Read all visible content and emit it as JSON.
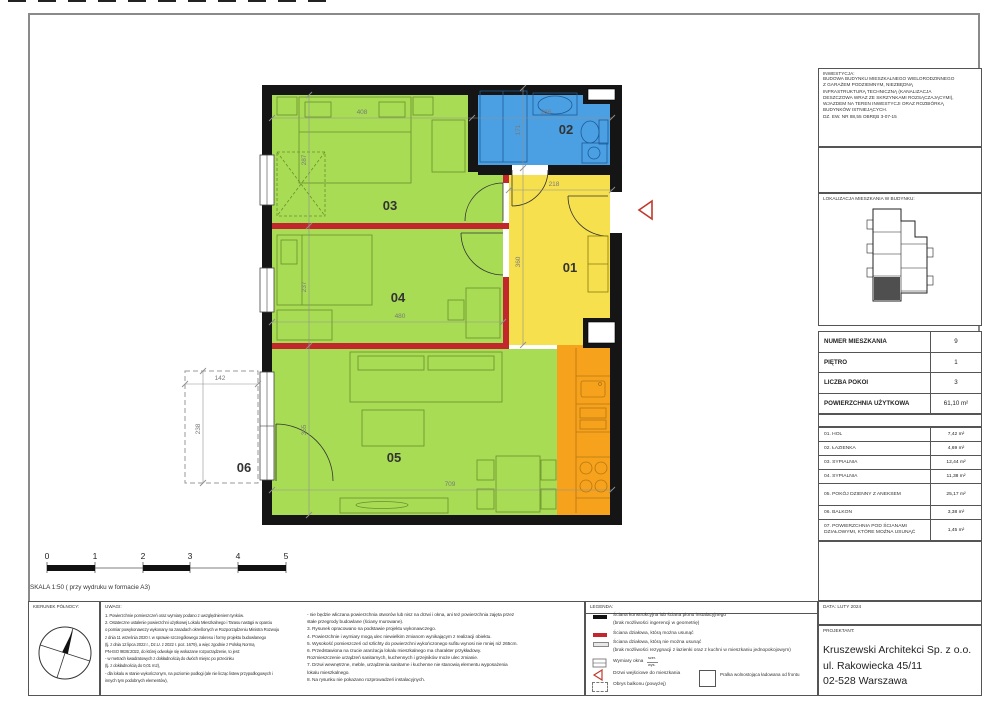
{
  "sheet": {
    "inwestycja": {
      "label": "INWESTYCJA:",
      "lines": [
        "BUDOWA BUDYNKU MIESZKALNEGO WIELORODZINNEGO",
        "Z GARAŻEM PODZIEMNYM, NIEZBĘDNĄ",
        "INFRASTRUKTURĄ TECHNICZNĄ (KANALIZACJA",
        "DESZCZOWA WRAZ ZE SKRZYNKAMI ROZSĄCZAJĄCYMI),",
        "WJAZDEM NA TEREN INWESTYCJI ORAZ ROZBIÓRKĄ",
        "BUDYNKÓW ISTNIEJĄCYCH.",
        "DZ. EW. NR 88,55 OBRĘB 3-07-15"
      ]
    },
    "lokalizacja_label": "LOKALIZACJA MIESZKANIA W BUDYNKU:",
    "apartment": {
      "rows": [
        {
          "label": "NUMER MIESZKANIA",
          "value": "9"
        },
        {
          "label": "PIĘTRO",
          "value": "1"
        },
        {
          "label": "LICZBA POKOI",
          "value": "3"
        },
        {
          "label": "POWIERZCHNIA UŻYTKOWA",
          "value": "61,10 m²"
        }
      ]
    },
    "areas": {
      "rows": [
        {
          "label": "01. HOL",
          "value": "7,42 m²"
        },
        {
          "label": "02. ŁAZIENKA",
          "value": "4,69 m²"
        },
        {
          "label": "03. SYPIALNIA",
          "value": "12,44 m²"
        },
        {
          "label": "04. SYPIALNIA",
          "value": "11,38 m²"
        },
        {
          "label": "05. POKÓJ DZIENNY Z ANEKSEM",
          "value": "25,17 m²"
        },
        {
          "label": "06. BALKON",
          "value": "3,38 m²"
        },
        {
          "label": "07. POWIERZCHNIA POD ŚCIANAMI DZIAŁOWYMI, KTÓRE MOŻNA USUNĄĆ",
          "value": "1,45 m²"
        }
      ]
    },
    "data_box": {
      "label": "DATA:",
      "value": "LUTY 2024"
    },
    "projektant": {
      "label": "PROJEKTANT:",
      "lines": [
        "Kruszewski Architekci Sp. z o.o.",
        "ul. Rakowiecka 45/11",
        "02-528 Warszawa"
      ]
    }
  },
  "plan": {
    "room_labels": {
      "r01": "01",
      "r02": "02",
      "r03": "03",
      "r04": "04",
      "r05": "05",
      "r06": "06"
    },
    "dims": {
      "w408": "408",
      "w286": "286",
      "h287": "287",
      "h171": "171",
      "w218": "218",
      "h360": "360",
      "h237": "237",
      "w480": "480",
      "h355": "355",
      "w709": "709",
      "w142": "142",
      "h238": "238"
    }
  },
  "scalebar": {
    "ticks": [
      "0",
      "1",
      "2",
      "3",
      "4",
      "5"
    ],
    "caption": "SKALA 1:50 ( przy wydruku w formacie A3)"
  },
  "footer": {
    "kierunek_label": "KIERUNEK PÓŁNOCY:",
    "uwagi": {
      "label": "UWAGI:",
      "col1": [
        "1. Powierzchnie pomieszczeń oraz wymiary podano z uwzględnieniem tynków.",
        "2. Ostateczne ustalenie powierzchni użytkowej Lokalu Mieszkalnego i Tarasu nastąpi w oparciu",
        "o pomiar powykonawczy wykonany na zasadach określonych w Rozporządzeniu Ministra Rozwoju",
        "z dnia 11 września 2020 r. w sprawie szczegółowego zakresu i formy projektu budowlanego",
        "(tj. z dnia 12 lipca 2022 r., Dz.U. z 2022 r. poz. 1679), a więc zgodnie z Polską Normą",
        "PN-ISO 9836:2022, do której odwołuje się wskazane rozporządzenie, to jest:",
        "- w metrach kwadratowych z dokładnością do dwóch miejsc po przecinku",
        "(tj. z dokładnością do 0,01 m2),",
        "- dla lokalu w stanie wykończonym, na poziomie podłogi (ale nie licząc listew przypodłogowych i",
        "innych tym podobnych elementów),"
      ],
      "col2": [
        "- nie będzie wliczana powierzchnia otworów lub nisz na drzwi i okna, ani też powierzchnia zajęta przez",
        "stałe przegrody budowlane (ściany murowane).",
        "3. Rysunek opracowano na podstawie projektu wykonawczego.",
        "4. Powierzchnie i wymiary mogą ulec niewielkim zmianom wynikającym z realizacji obiektu.",
        "5. Wysokość pomieszczeń od szlichty do powierzchni wykończonego sufitu wynosi nie mniej niż 265cm.",
        "6. Przedstawiona na rzucie aranżacja lokalu mieszkalnego ma charakter przykładowy.",
        "Rozmieszczenie urządzeń sanitarnych, kuchennych i grzejników może ulec zmianie.",
        "7. Drzwi wewnętrzne, meble, urządzenia sanitarne i kuchenne nie stanowią elementu wyposażenia",
        "lokalu mieszkalnego.",
        "8. Na rysunku nie pokazano rozprowadzeń instalacyjnych."
      ]
    },
    "legenda": {
      "label": "LEGENDA:",
      "item1a": "Ściana konstrukcyjna lub ściana pionu instalacyjnego",
      "item1b": "(brak możliwości ingerencji w geometrię)",
      "item2": "Ściana działowa, którą można usunąć",
      "item3a": "Ściana działowa, którą nie można usunąć",
      "item3b": "(brak możliwości rezygnacji z łazienki oraz z kuchni w mieszkaniu jednopokojowym)",
      "item4": "Wymiary okna",
      "item4_note_top": "szer.",
      "item4_note_bottom": "wys.",
      "item5": "Drzwi wejściowe do mieszkania",
      "item6": "Obrys balkonu (powyżej)",
      "item7": "Pralka wolnostojąca ładowana od frontu"
    }
  },
  "colors": {
    "green": "#a8dc55",
    "blue": "#4aa0e2",
    "yellow": "#f6e04e",
    "orange": "#f6a21d",
    "wall_red": "#c1272d",
    "wall_black": "#151515"
  }
}
